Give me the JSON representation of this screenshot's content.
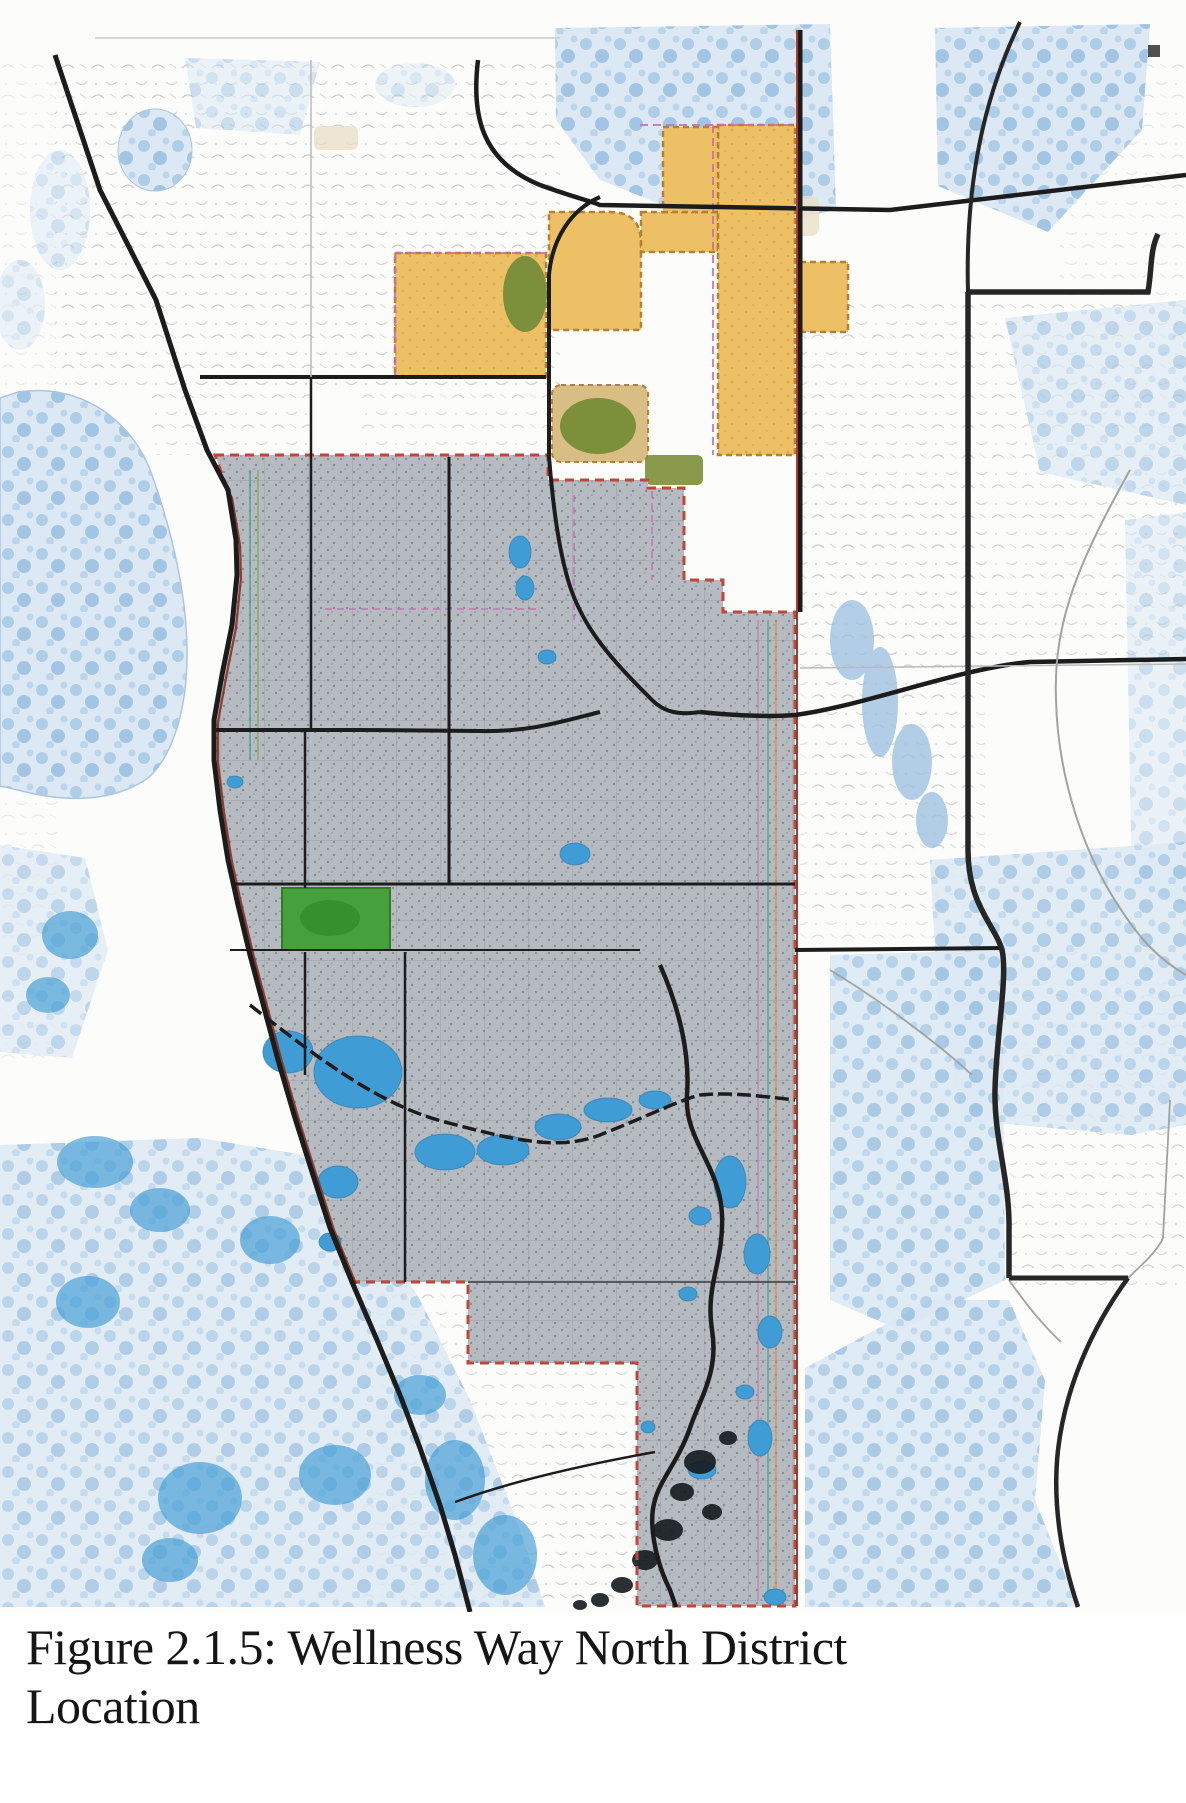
{
  "figure": {
    "caption": {
      "line1": "Figure 2.1.5: Wellness Way North District",
      "line2": "Location"
    }
  },
  "map": {
    "palette": {
      "map_land": "#fcfcfb",
      "water_mottle_bg": "#dce9f4",
      "water_mottle_blob": "#a6c8e5",
      "water_bright": "#3f9cd4",
      "water_pale_outline": "#adc6dd",
      "district_fill": "#b6bbc1",
      "district_stipple": "#79818a",
      "district_border": "#c0463a",
      "boundary_dark_red": "#8a2f1d",
      "road_black": "#1c1c1c",
      "road_gray": "#b9bcb9",
      "county_line": "#262626",
      "development_fill": "#eec066",
      "development_border": "#b5802f",
      "boundary_pink": "#d06ab0",
      "boundary_teal": "#3f9e8d",
      "boundary_green": "#7aa84f",
      "boundary_orange": "#d98a3a",
      "tan_parcel": "#d8bd85",
      "olive_green": "#7c8f3a",
      "park_green": "#46a13c",
      "marsh_dark": "#161b20",
      "caption_text": "#151515"
    }
  }
}
